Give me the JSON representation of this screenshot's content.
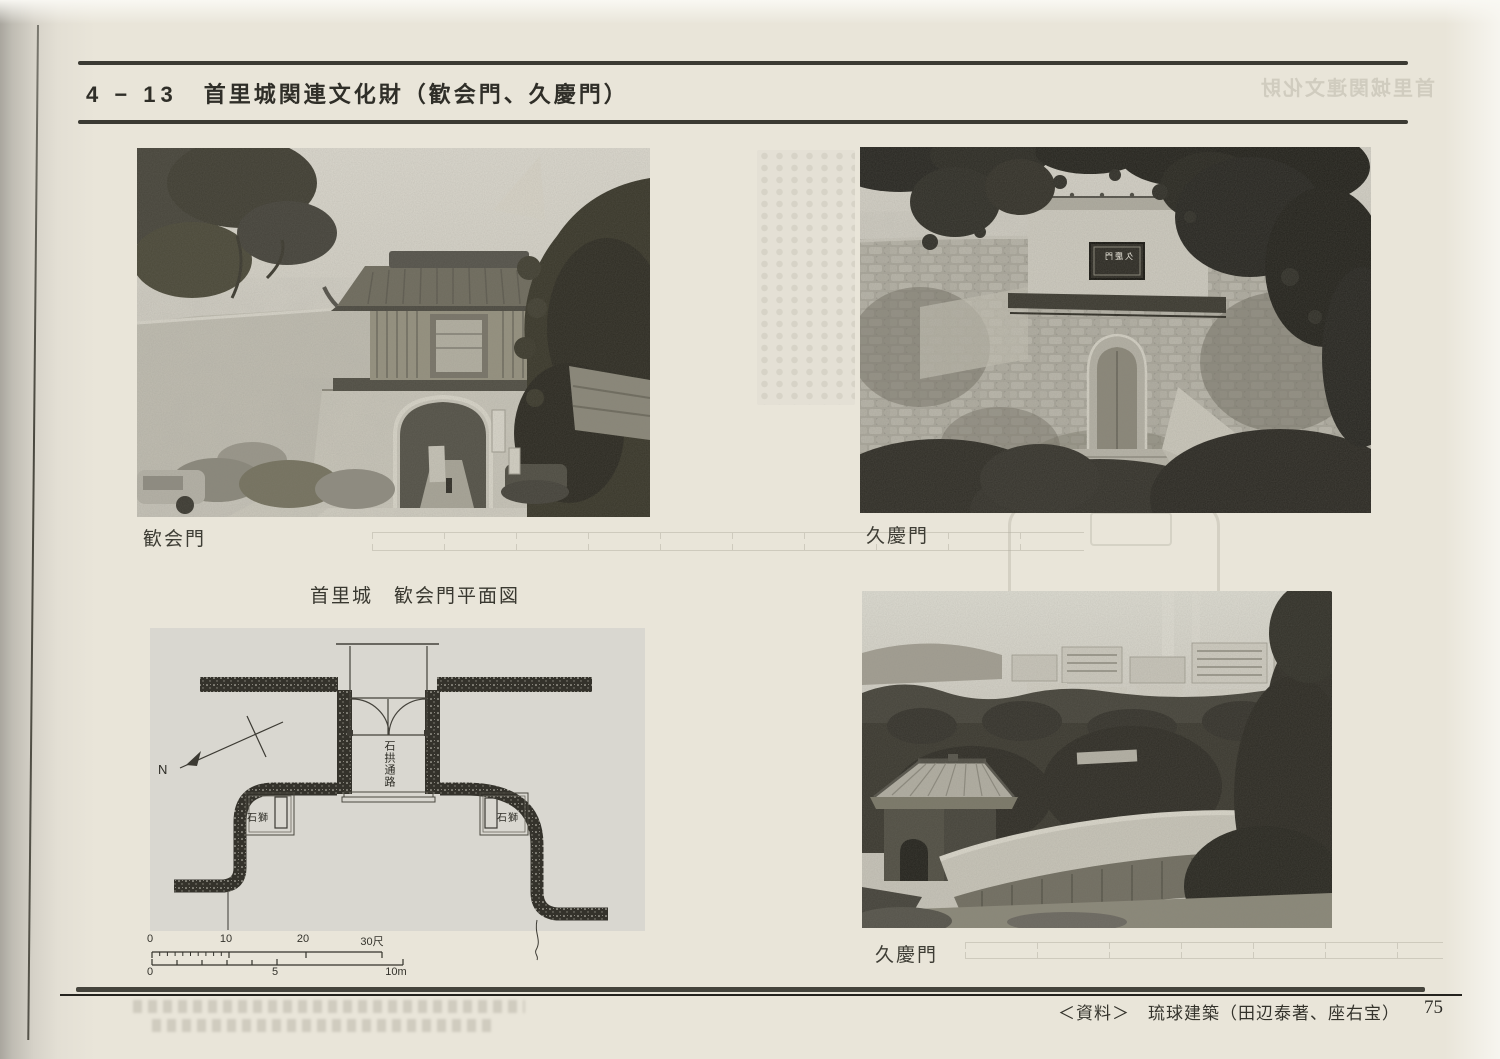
{
  "header": {
    "section_no": "4 − 13",
    "title": "首里城関連文化財（歓会門、久慶門）"
  },
  "ghost": {
    "header_mirrored": "首里城関連文化財"
  },
  "photos": {
    "kankaimon": {
      "caption": "歓会門"
    },
    "kyukeimon_front": {
      "caption": "久慶門",
      "plaque": "久慶門"
    },
    "kyukeimon_above": {
      "caption": "久慶門"
    }
  },
  "plan": {
    "title": "首里城　歓会門平面図",
    "passage_label": "石拱通路",
    "lion_label": "石獅",
    "north_label": "N",
    "scale_shaku": [
      "0",
      "10",
      "20",
      "30尺"
    ],
    "scale_m": [
      "0",
      "5",
      "10m"
    ]
  },
  "footer": {
    "source": "＜資料＞　琉球建築（田辺泰著、座右宝）",
    "page_no": "75"
  }
}
